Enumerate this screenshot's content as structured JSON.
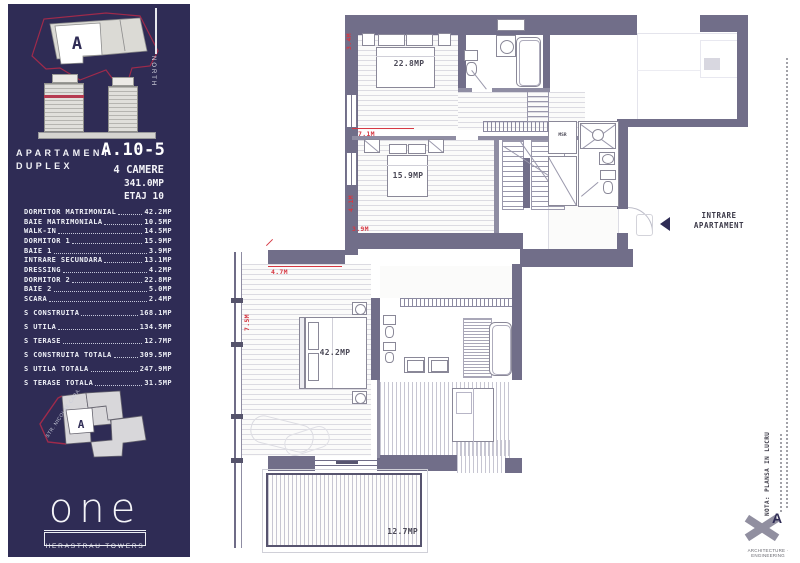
{
  "sidebar": {
    "bg_color": "#2f2c55",
    "accent_red": "#a02a4b",
    "north_label": "NORTH",
    "site_map_marker": "A",
    "street_map_marker": "A",
    "street_label": "STR. NICOLAE CARAMFIL",
    "title": {
      "label": "APARTAMENT",
      "code": "A.10-5",
      "type": "DUPLEX",
      "rooms_count": "4 CAMERE",
      "total_area": "341.0MP",
      "floor": "ETAJ 10"
    },
    "room_rows": [
      {
        "label": "DORMITOR MATRIMONIAL",
        "value": "42.2MP"
      },
      {
        "label": "BAIE MATRIMONIALA",
        "value": "10.5MP"
      },
      {
        "label": "WALK-IN",
        "value": "14.5MP"
      },
      {
        "label": "DORMITOR 1",
        "value": "15.9MP"
      },
      {
        "label": "BAIE 1",
        "value": "3.9MP"
      },
      {
        "label": "INTRARE SECUNDARA",
        "value": "13.1MP"
      },
      {
        "label": "DRESSING",
        "value": "4.2MP"
      },
      {
        "label": "DORMITOR 2",
        "value": "22.8MP"
      },
      {
        "label": "BAIE 2",
        "value": "5.0MP"
      },
      {
        "label": "SCARA",
        "value": "2.4MP"
      },
      {
        "label": "S CONSTRUITA",
        "value": "168.1MP"
      },
      {
        "label": "S UTILA",
        "value": "134.5MP"
      },
      {
        "label": "S TERASE",
        "value": "12.7MP"
      },
      {
        "label": "S CONSTRUITA TOTALA",
        "value": "309.5MP"
      },
      {
        "label": "S UTILA TOTALA",
        "value": "247.9MP"
      },
      {
        "label": "S TERASE TOTALA",
        "value": "31.5MP"
      }
    ],
    "logo": {
      "name": "one",
      "subtitle": "HERASTRAU TOWERS"
    }
  },
  "plan": {
    "wall_color": "#716e89",
    "dimension_color": "#d63843",
    "labels": {
      "dormitor2_area": "22.8MP",
      "dormitor1_area": "15.9MP",
      "matrimonial_area": "42.2MP",
      "terasa_area": "12.7MP",
      "msr": "MSR"
    },
    "dimensions": {
      "d34": "3.4M",
      "d71": "7.1M",
      "d41": "4.1M",
      "d39": "3.9M",
      "d47": "4.7M",
      "d75": "7.5M"
    },
    "entrance": {
      "line1": "INTRARE",
      "line2": "APARTAMENT"
    }
  },
  "annotations": {
    "nota": "NOTA: PLANSA IN LUCRU",
    "firm_letter": "A",
    "firm_tagline": "ARCHITECTURE · ENGINEERING"
  }
}
